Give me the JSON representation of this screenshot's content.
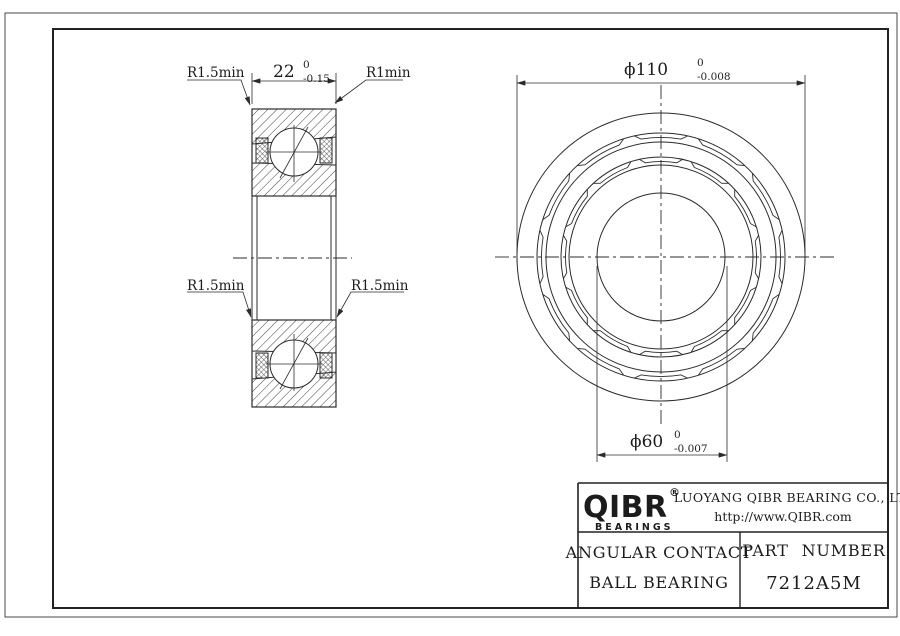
{
  "drawing": {
    "dimensions": {
      "width": {
        "value": "22",
        "upper": "0",
        "lower": "-0.15"
      },
      "outer_diameter": {
        "value": "ϕ110",
        "upper": "0",
        "lower": "-0.008"
      },
      "bore_diameter": {
        "value": "ϕ60",
        "upper": "0",
        "lower": "-0.007"
      },
      "fillet_top_left": "R1.5min",
      "fillet_top_right": "R1min",
      "fillet_bottom_left": "R1.5min",
      "fillet_bottom_right": "R1.5min"
    }
  },
  "title_block": {
    "logo": {
      "text": "QIBR",
      "registered": "®",
      "subtext": "BEARINGS"
    },
    "company": "LUOYANG QIBR BEARING CO., LTD",
    "website": "http://www.QIBR.com",
    "product_line1": "ANGULAR CONTACT",
    "product_line2": "BALL BEARING",
    "part_number_label": "PART NUMBER",
    "part_number": "7212A5M"
  },
  "colors": {
    "line": "#2b2b2b",
    "background": "#ffffff"
  }
}
